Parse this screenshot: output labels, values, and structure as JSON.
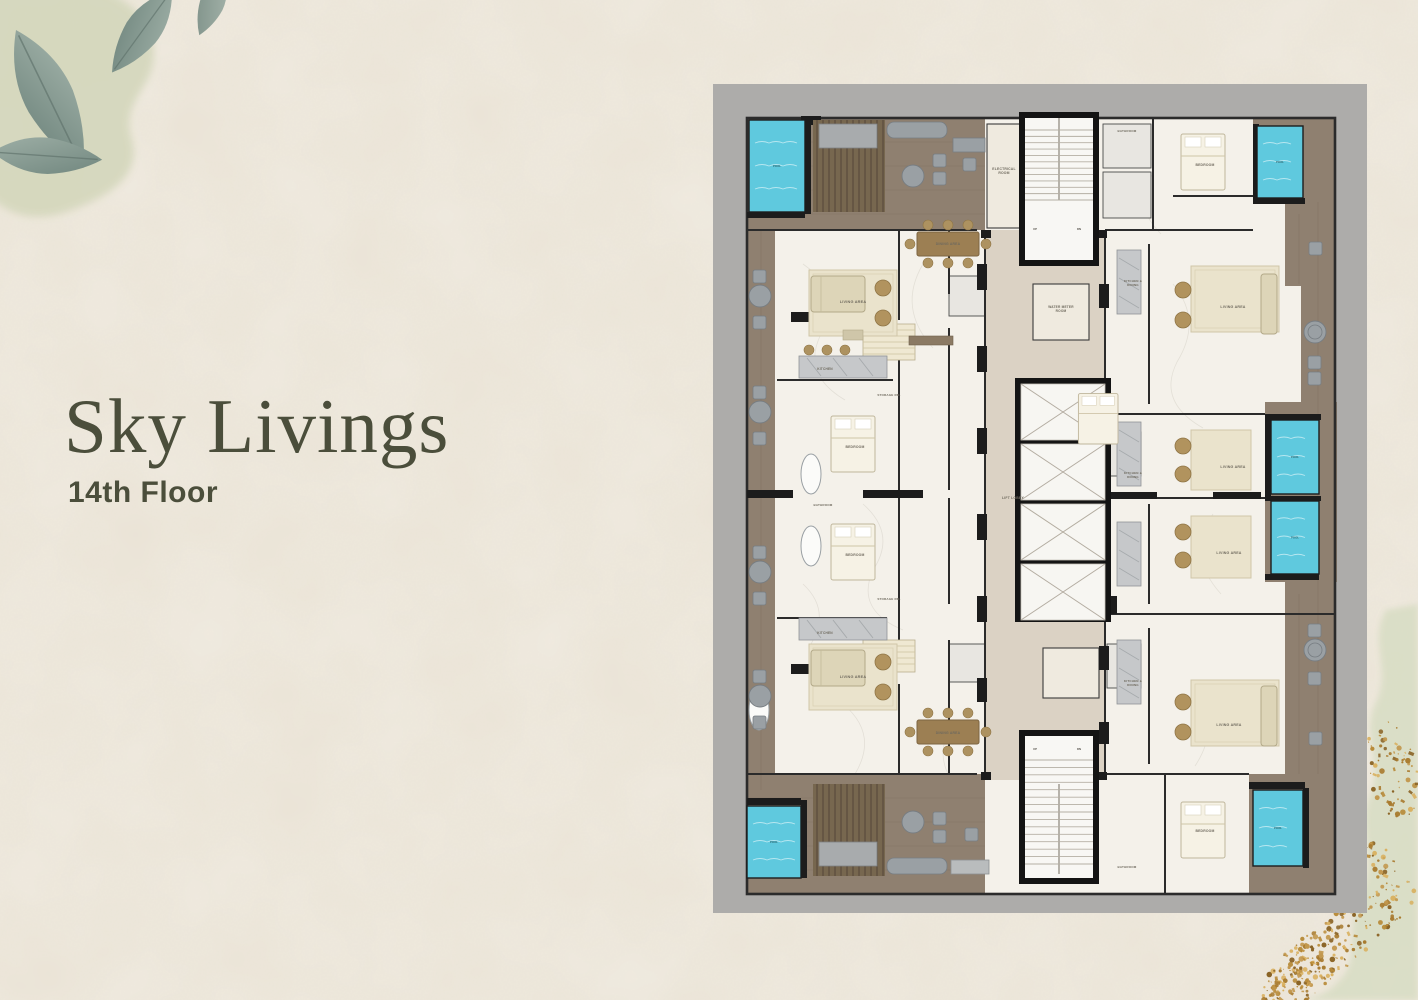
{
  "page": {
    "title": "Sky Livings",
    "subtitle": "14th Floor"
  },
  "floorplan": {
    "kind": "residential tower floor plan",
    "colors": {
      "frame": "#adacaa",
      "floor": "#f4f1ea",
      "wall": "#1c1c1c",
      "wood": "#8f8070",
      "pergola": "#77674f",
      "corridor": "#dbd2c4",
      "pool": "#5fc9de",
      "rug": "#eae3cc",
      "furniture_tan": "#b1935e",
      "furniture_gray": "#9aa0a4"
    },
    "pools": [
      {
        "x": 36,
        "y": 36,
        "w": 56,
        "h": 92,
        "label": "POOL"
      },
      {
        "x": 544,
        "y": 42,
        "w": 46,
        "h": 72,
        "label": "POOL"
      },
      {
        "x": 558,
        "y": 336,
        "w": 48,
        "h": 74,
        "label": "POOL"
      },
      {
        "x": 558,
        "y": 417,
        "w": 48,
        "h": 73,
        "label": "POOL"
      },
      {
        "x": 34,
        "y": 722,
        "w": 54,
        "h": 72,
        "label": "POOL"
      },
      {
        "x": 540,
        "y": 706,
        "w": 50,
        "h": 76,
        "label": "POOL"
      }
    ],
    "elevator": {
      "x": 308,
      "y": 300,
      "w": 84,
      "cell_h": 56,
      "gap": 4,
      "count": 4
    },
    "stairs": [
      {
        "x": 312,
        "y": 46,
        "w": 68,
        "h": 70,
        "steps": 11,
        "rail": true
      },
      {
        "x": 312,
        "y": 676,
        "w": 68,
        "h": 104,
        "steps": 14,
        "rail": true
      }
    ],
    "updn": [
      {
        "t": "UP",
        "x": 322,
        "y": 146
      },
      {
        "t": "DN",
        "x": 366,
        "y": 146
      },
      {
        "t": "UP",
        "x": 322,
        "y": 666
      },
      {
        "t": "DN",
        "x": 366,
        "y": 666
      }
    ],
    "labels": [
      {
        "t": "ELECTRICAL|ROOM",
        "x": 291,
        "y": 86,
        "s": 3.4
      },
      {
        "t": "WATER METER|ROOM",
        "x": 348,
        "y": 224,
        "s": 3.2
      },
      {
        "t": "LIFT LOBBY",
        "x": 300,
        "y": 415,
        "s": 3.4
      },
      {
        "t": "LIVING AREA",
        "x": 140,
        "y": 219,
        "s": 3.8
      },
      {
        "t": "DINING AREA",
        "x": 235,
        "y": 161,
        "s": 3.4
      },
      {
        "t": "KITCHEN",
        "x": 112,
        "y": 286,
        "s": 3.2
      },
      {
        "t": "STORAGE RM.",
        "x": 176,
        "y": 312,
        "s": 3.0
      },
      {
        "t": "BEDROOM",
        "x": 142,
        "y": 364,
        "s": 3.4
      },
      {
        "t": "BATHROOM",
        "x": 110,
        "y": 422,
        "s": 3.0
      },
      {
        "t": "BEDROOM",
        "x": 142,
        "y": 472,
        "s": 3.4
      },
      {
        "t": "STORAGE RM.",
        "x": 176,
        "y": 516,
        "s": 3.0
      },
      {
        "t": "KITCHEN",
        "x": 112,
        "y": 550,
        "s": 3.2
      },
      {
        "t": "LIVING AREA",
        "x": 140,
        "y": 594,
        "s": 3.8
      },
      {
        "t": "DINING AREA",
        "x": 235,
        "y": 650,
        "s": 3.4
      },
      {
        "t": "BATHROOM",
        "x": 414,
        "y": 48,
        "s": 3.0
      },
      {
        "t": "BEDROOM",
        "x": 492,
        "y": 82,
        "s": 3.4
      },
      {
        "t": "KITCHEN &|DINING",
        "x": 420,
        "y": 198,
        "s": 3.0
      },
      {
        "t": "LIVING AREA",
        "x": 520,
        "y": 224,
        "s": 3.6
      },
      {
        "t": "LIVING AREA",
        "x": 520,
        "y": 384,
        "s": 3.6
      },
      {
        "t": "KITCHEN &|DINING",
        "x": 420,
        "y": 390,
        "s": 3.0
      },
      {
        "t": "LIVING AREA",
        "x": 516,
        "y": 470,
        "s": 3.6
      },
      {
        "t": "KITCHEN &|DINING",
        "x": 420,
        "y": 598,
        "s": 3.0
      },
      {
        "t": "LIVING AREA",
        "x": 516,
        "y": 642,
        "s": 3.6
      },
      {
        "t": "BEDROOM",
        "x": 492,
        "y": 748,
        "s": 3.4
      },
      {
        "t": "BATHROOM",
        "x": 414,
        "y": 784,
        "s": 3.0
      }
    ]
  },
  "decor": {
    "leaf_color": "#8ba098",
    "wash_color": "#d4d7bc",
    "gold_colors": [
      "#a87a2e",
      "#c2974d",
      "#8a6325",
      "#d9b05f",
      "#b78a38"
    ],
    "gold_clusters": [
      {
        "cx": 152,
        "cy": 170,
        "rx": 24,
        "ry": 56,
        "rot": -15,
        "n": 70
      },
      {
        "cx": 140,
        "cy": 262,
        "rx": 14,
        "ry": 24,
        "rot": -45,
        "n": 28
      },
      {
        "cx": 100,
        "cy": 338,
        "rx": 92,
        "ry": 26,
        "rot": -36,
        "n": 190
      },
      {
        "cx": 58,
        "cy": 382,
        "rx": 42,
        "ry": 20,
        "rot": -30,
        "n": 80
      },
      {
        "cx": 115,
        "cy": 106,
        "rx": 10,
        "ry": 16,
        "rot": 0,
        "n": 10
      }
    ]
  }
}
